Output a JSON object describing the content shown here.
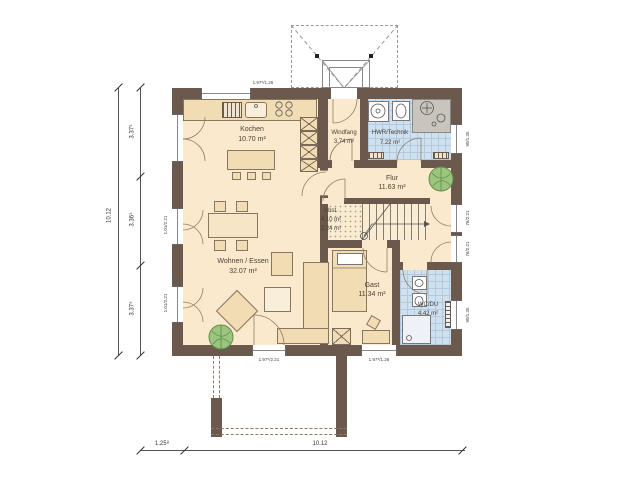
{
  "plan": {
    "rooms": [
      {
        "name": "Kochen",
        "area": "10.70 m²"
      },
      {
        "name": "Windfang",
        "area": "3.74 m²"
      },
      {
        "name": "HWR/Technik",
        "area": "7.22 m²"
      },
      {
        "name": "Flur",
        "area": "11.63 m²"
      },
      {
        "name": "Abst.",
        "area": "4.10 m²",
        "area2": "2.24 m²"
      },
      {
        "name": "Wohnen / Essen",
        "area": "32.07 m²"
      },
      {
        "name": "Gast",
        "area": "11.34 m²"
      },
      {
        "name": "WC/DU",
        "area": "4.42 m²"
      }
    ],
    "dimensions": {
      "left_total": "10.12",
      "left_segments": [
        "3.37⁵",
        "3.36⁴",
        "3.37⁵"
      ],
      "bottom_offset": "1.25⁸",
      "bottom_total": "10.12"
    },
    "window_labels": {
      "top_kitchen": "1.97⁵/1.26",
      "bottom_terrace": "1.97⁵/2.21",
      "bottom_gast": "1.97⁵/1.26",
      "left_upper": "1.01/2.21",
      "left_lower": "1.01/2.21",
      "right_hwr": "90/1.35",
      "right_hall_upper": "76/2.21",
      "right_hall_lower": "76/2.21",
      "right_wc": "90/1.35"
    },
    "colors": {
      "wall": "#6a594c",
      "floor": "#fbe9ce",
      "tile": "#cfe0ee",
      "furniture": "#f1dcb4",
      "plant": "#9cc47e"
    }
  }
}
